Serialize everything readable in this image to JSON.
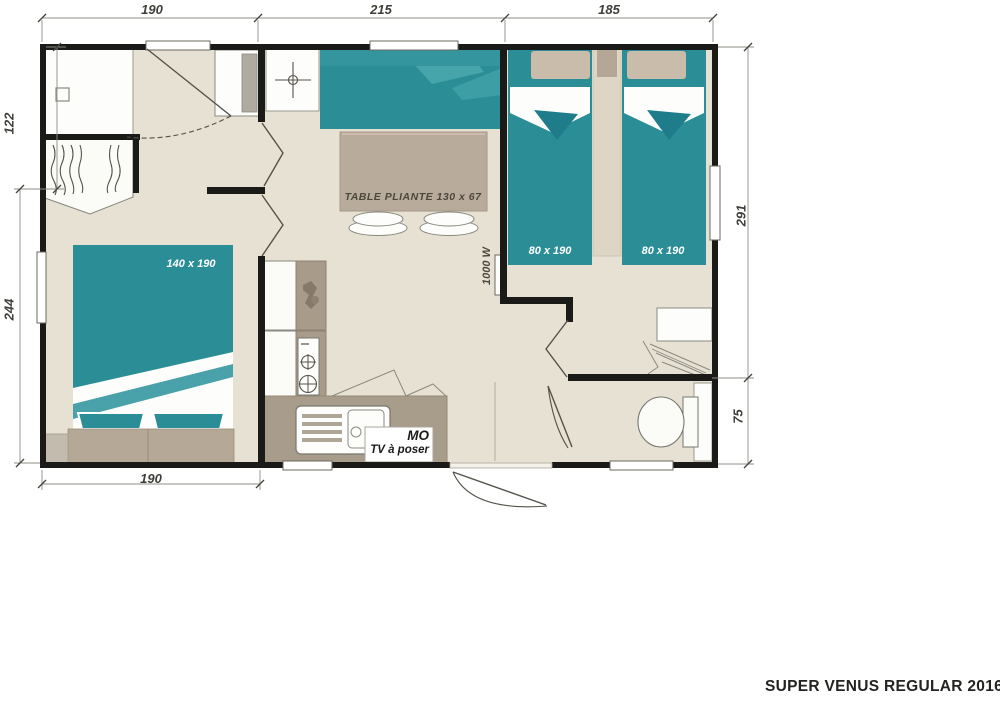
{
  "page": {
    "title_plate": "SUPER VENUS REGULAR 2016"
  },
  "dimensions_cm": {
    "top_left": "190",
    "top_middle": "215",
    "top_right": "185",
    "left_upper": "122",
    "left_lower": "244",
    "right_upper": "291",
    "right_lower": "75",
    "bottom": "190"
  },
  "room_labels": {
    "double_bed": "140 x 190",
    "single_bed_left": "80 x 190",
    "single_bed_right": "80 x 190",
    "folding_table": "TABLE PLIANTE 130 x 67",
    "heater": "1000 W",
    "microwave": "MO",
    "tv": "TV à poser"
  },
  "colors": {
    "teal": "#2b8e97",
    "teal_light": "#45a5ab",
    "teal_dark": "#1f7d8b",
    "floor": "#e6e1d2",
    "taupe": "#a99c8a",
    "taupe_table": "#b9ab9c",
    "wall": "#1a1a18"
  }
}
